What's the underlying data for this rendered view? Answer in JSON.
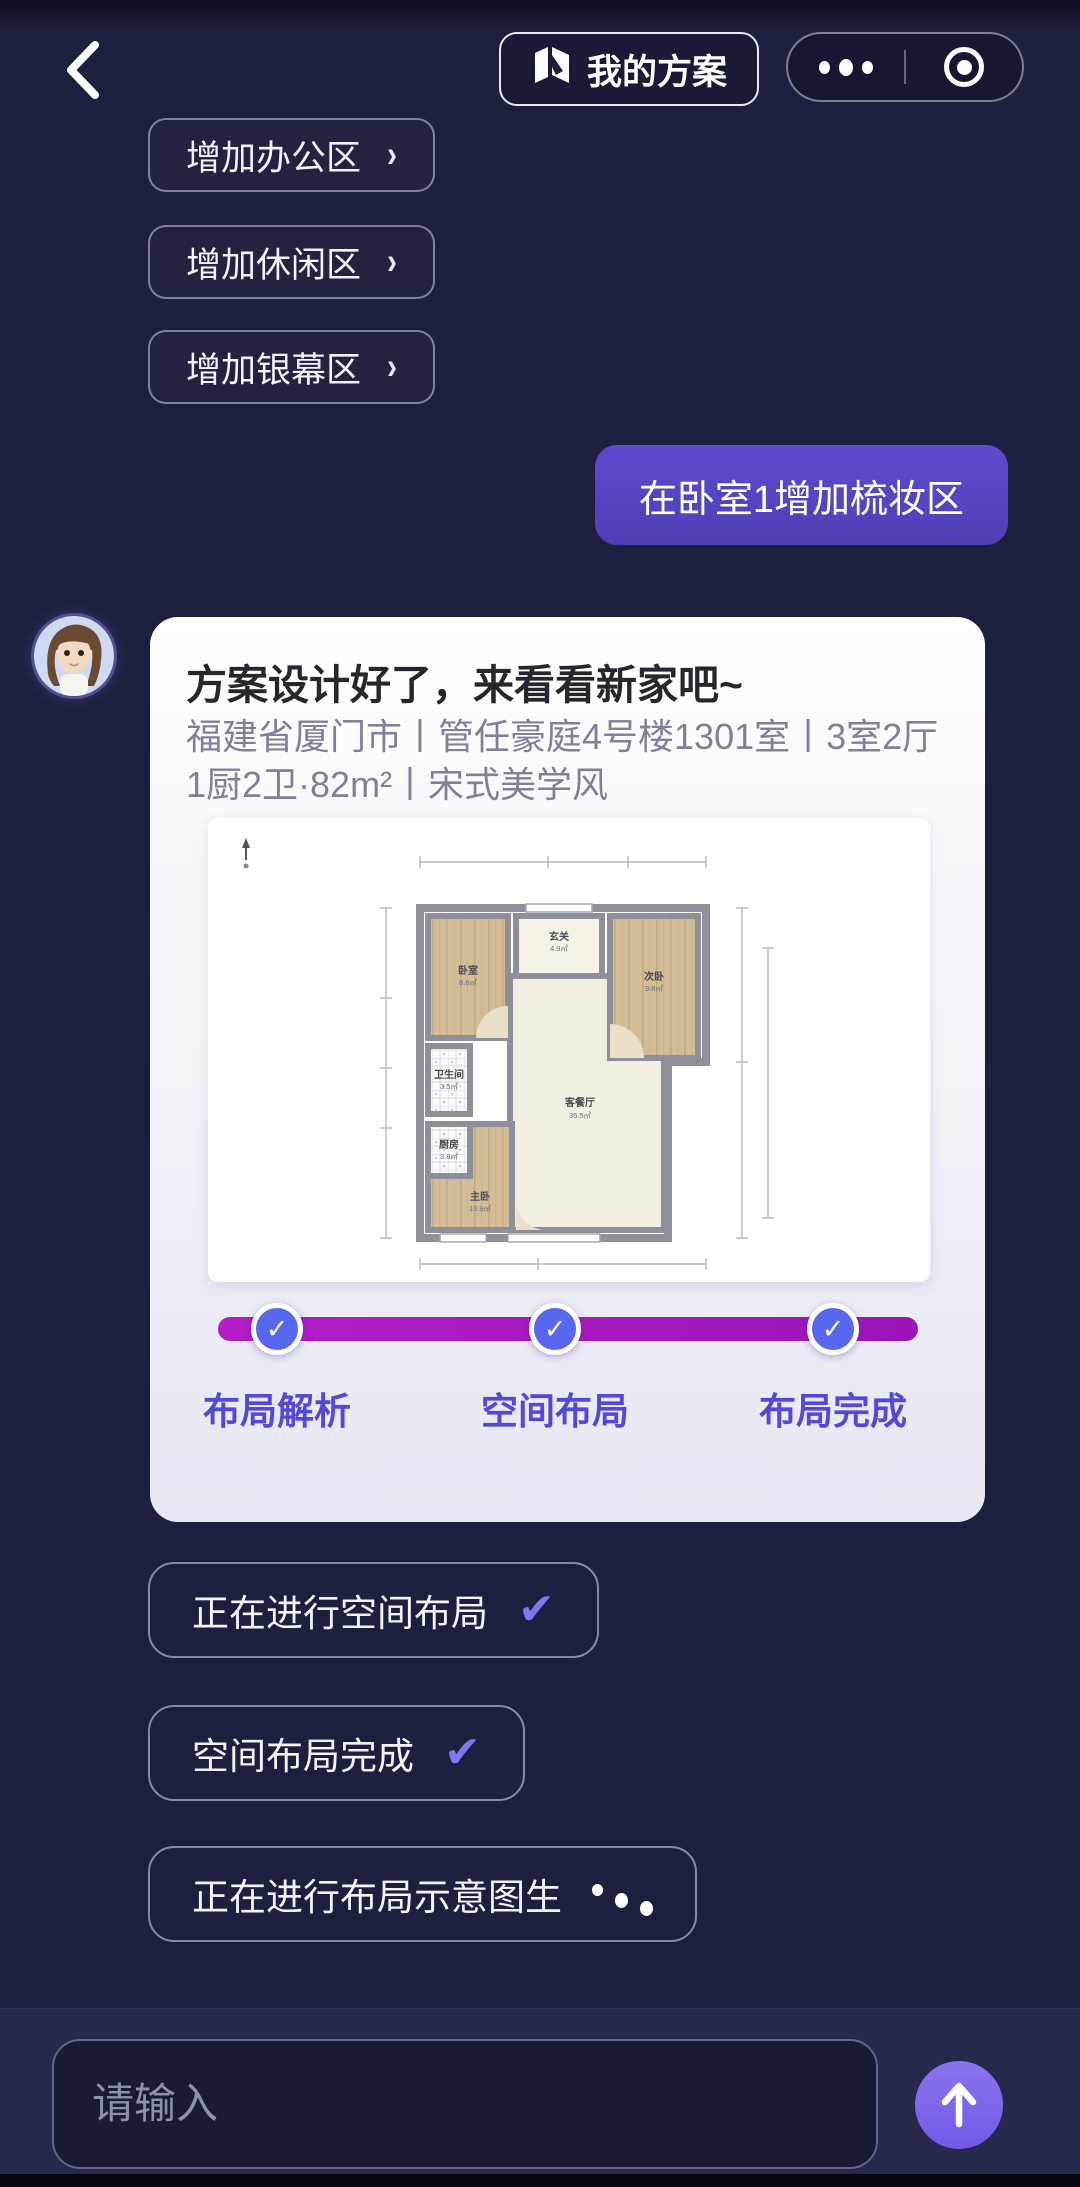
{
  "topbar": {
    "back_icon": "chevron-left",
    "my_plans_label": "我的方案",
    "capsule": {
      "more_icon": "ellipsis",
      "close_icon": "record-circle"
    }
  },
  "suggestions": [
    {
      "label": "增加办公区",
      "chevron": "›"
    },
    {
      "label": "增加休闲区",
      "chevron": "›"
    },
    {
      "label": "增加银幕区",
      "chevron": "›"
    }
  ],
  "user_message": {
    "text": "在卧室1增加梳妆区"
  },
  "assistant_card": {
    "title": "方案设计好了，来看看新家吧~",
    "subtitle": "福建省厦门市丨管任豪庭4号楼1301室丨3室2厅1厨2卫·82m²丨宋式美学风",
    "floorplan": {
      "rooms": [
        {
          "name": "卧室",
          "area": "8.6㎡"
        },
        {
          "name": "玄关",
          "area": "4.9㎡"
        },
        {
          "name": "次卧",
          "area": "9.8㎡"
        },
        {
          "name": "卫生间",
          "area": "3.5㎡"
        },
        {
          "name": "厨房",
          "area": "3.8㎡"
        },
        {
          "name": "主卧",
          "area": "13.9㎡"
        },
        {
          "name": "客餐厅",
          "area": "35.5㎡"
        }
      ]
    },
    "progress_steps": [
      {
        "label": "布局解析",
        "done": true,
        "check": "✓"
      },
      {
        "label": "空间布局",
        "done": true,
        "check": "✓"
      },
      {
        "label": "布局完成",
        "done": true,
        "check": "✓"
      }
    ]
  },
  "status_messages": [
    {
      "text": "正在进行空间布局",
      "state": "check",
      "check": "✔"
    },
    {
      "text": "空间布局完成",
      "state": "check",
      "check": "✔"
    },
    {
      "text": "正在进行布局示意图生",
      "state": "loading"
    }
  ],
  "composer": {
    "placeholder": "请输入",
    "send_icon": "arrow-up"
  },
  "colors": {
    "background": "#1d1f3e",
    "user_bubble": "#5847c6",
    "card_bg": "#f2f2f9",
    "progress_bar": "#a81bc0",
    "checkpoint": "#5868ee",
    "step_label": "#5349d8",
    "send_button": "#7e63ec",
    "chip_border": "#cdd2eb"
  }
}
